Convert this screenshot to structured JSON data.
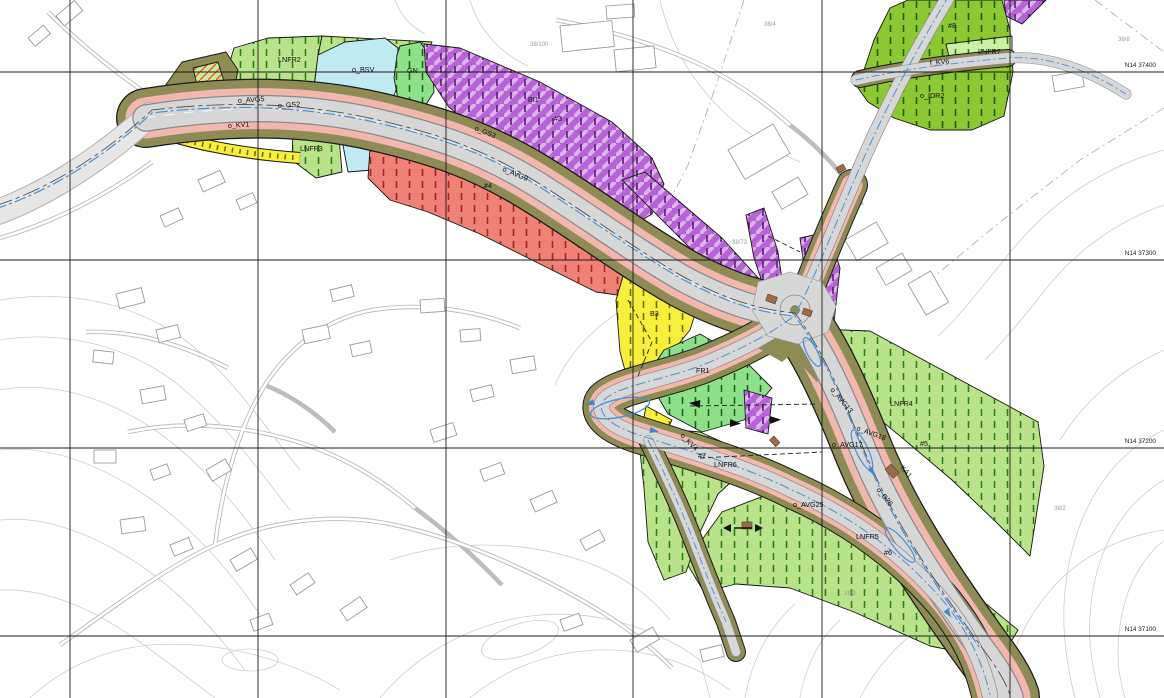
{
  "map": {
    "type": "zoning-plan-map",
    "grid_labels": [
      {
        "id": "n14-37400",
        "text": "N14 37400",
        "x": 1156,
        "y": 67
      },
      {
        "id": "n14-37300",
        "text": "N14 37300",
        "x": 1156,
        "y": 255
      },
      {
        "id": "n14-37200",
        "text": "N14 37200",
        "x": 1156,
        "y": 443
      },
      {
        "id": "n14-37100",
        "text": "N14 37100",
        "x": 1156,
        "y": 631
      }
    ],
    "zone_labels": [
      {
        "id": "o-bsv",
        "text": "o_BSV",
        "x": 352,
        "y": 72,
        "rot": 0
      },
      {
        "id": "lnfr2",
        "text": "LNFR2",
        "x": 278,
        "y": 62,
        "rot": 0
      },
      {
        "id": "gn",
        "text": "GN",
        "x": 407,
        "y": 73,
        "rot": 0
      },
      {
        "id": "bi1",
        "text": "BI1",
        "x": 528,
        "y": 102,
        "rot": 0
      },
      {
        "id": "hash3",
        "text": "#3",
        "x": 554,
        "y": 121,
        "rot": 0
      },
      {
        "id": "o-gs3",
        "text": "o_GS3",
        "x": 474,
        "y": 130,
        "rot": 22
      },
      {
        "id": "o-kv1",
        "text": "o_KV1",
        "x": 228,
        "y": 128,
        "rot": -4
      },
      {
        "id": "o-gs2",
        "text": "o_GS2",
        "x": 278,
        "y": 108,
        "rot": -4
      },
      {
        "id": "o-avg5",
        "text": "o_AVG5",
        "x": 238,
        "y": 103,
        "rot": -4
      },
      {
        "id": "o-avg9",
        "text": "o_AVG9",
        "x": 502,
        "y": 171,
        "rot": 22
      },
      {
        "id": "hash4",
        "text": "#4",
        "x": 484,
        "y": 188,
        "rot": 0
      },
      {
        "id": "lnfr3",
        "text": "LNFR3",
        "x": 300,
        "y": 151,
        "rot": 0
      },
      {
        "id": "b3",
        "text": "B3",
        "x": 650,
        "y": 316,
        "rot": 0
      },
      {
        "id": "fr1",
        "text": "FR1",
        "x": 696,
        "y": 373,
        "rot": 0
      },
      {
        "id": "lnfr6",
        "text": "LNFR6",
        "x": 714,
        "y": 467,
        "rot": 0
      },
      {
        "id": "hash7",
        "text": "#7",
        "x": 698,
        "y": 458,
        "rot": 0
      },
      {
        "id": "o-kv4",
        "text": "o_KV4",
        "x": 680,
        "y": 436,
        "rot": 45
      },
      {
        "id": "o-avg25",
        "text": "o_AVG25",
        "x": 793,
        "y": 507,
        "rot": 0
      },
      {
        "id": "lnfr5",
        "text": "LNFR5",
        "x": 856,
        "y": 539,
        "rot": 0
      },
      {
        "id": "hash6",
        "text": "#6",
        "x": 884,
        "y": 555,
        "rot": 0
      },
      {
        "id": "lnfr4",
        "text": "LNFR4",
        "x": 890,
        "y": 406,
        "rot": 0
      },
      {
        "id": "hash5",
        "text": "#5",
        "x": 920,
        "y": 446,
        "rot": 0
      },
      {
        "id": "o-avg13",
        "text": "o_AVG13",
        "x": 830,
        "y": 390,
        "rot": 50
      },
      {
        "id": "o-avg18",
        "text": "o_AVG18",
        "x": 856,
        "y": 430,
        "rot": 20
      },
      {
        "id": "o-avg17",
        "text": "o_AVG17",
        "x": 832,
        "y": 447,
        "rot": 0
      },
      {
        "id": "o-g26",
        "text": "o_G26",
        "x": 876,
        "y": 490,
        "rot": 50
      },
      {
        "id": "ka1",
        "text": "KA1",
        "x": 900,
        "y": 468,
        "rot": 50
      },
      {
        "id": "o-idr2",
        "text": "o_IDR2",
        "x": 920,
        "y": 98,
        "rot": 0
      },
      {
        "id": "hash8",
        "text": "#8",
        "x": 948,
        "y": 28,
        "rot": 0
      },
      {
        "id": "lnfr7",
        "text": "LNFR7",
        "x": 978,
        "y": 54,
        "rot": 0
      },
      {
        "id": "f-kv6",
        "text": "f_KV6",
        "x": 930,
        "y": 65,
        "rot": -4
      }
    ],
    "parcel_labels": [
      {
        "id": "p38-4",
        "text": "38/4",
        "x": 764,
        "y": 26
      },
      {
        "id": "p38-100",
        "text": "38/100",
        "x": 530,
        "y": 46
      },
      {
        "id": "p38-73",
        "text": "38/73",
        "x": 732,
        "y": 244
      },
      {
        "id": "p38-2",
        "text": "38/2",
        "x": 1054,
        "y": 510
      },
      {
        "id": "p38-3",
        "text": "38/3",
        "x": 844,
        "y": 595
      },
      {
        "id": "p38-8",
        "text": "38/8",
        "x": 1118,
        "y": 41
      }
    ],
    "colors": {
      "residential_yellow": "#f8ee3c",
      "industry_purple": "#b763d8",
      "lnfr_green": "#b9e38b",
      "lnfr_pale_green": "#c9efa4",
      "sports_green": "#8cc832",
      "park_green": "#8ee08a",
      "water_cyan": "#bfeaf2",
      "construction_red": "#ef8176",
      "road_verge_olive": "#8e8b55",
      "footway_pink": "#f3b7ae",
      "road_gray": "#d7d7d7",
      "guide_blue": "#3f87cc",
      "grid_black": "#1b1b1b"
    }
  }
}
